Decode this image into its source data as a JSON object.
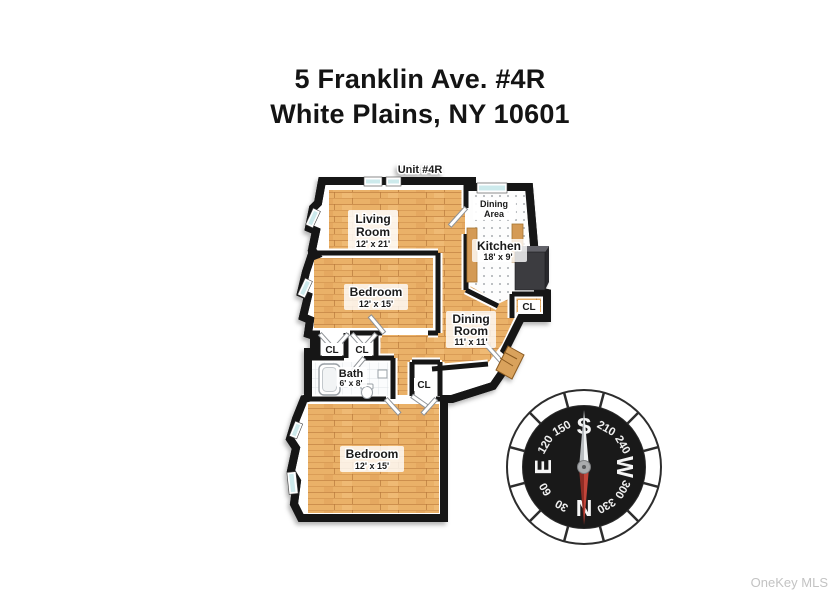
{
  "title": {
    "line1": "5 Franklin Ave. #4R",
    "line2": "White Plains, NY 10601"
  },
  "floorplan": {
    "unit_label": "Unit #4R",
    "rooms": {
      "living": {
        "name1": "Living",
        "name2": "Room",
        "dims": "12' x 21'"
      },
      "dining_area": {
        "name1": "Dining",
        "name2": "Area"
      },
      "kitchen": {
        "name": "Kitchen",
        "dims": "18' x 9'"
      },
      "bedroom1": {
        "name": "Bedroom",
        "dims": "12' x 15'"
      },
      "dining_room": {
        "name1": "Dining",
        "name2": "Room",
        "dims": "11' x 11'"
      },
      "bath": {
        "name": "Bath",
        "dims": "6' x 8'"
      },
      "bedroom2": {
        "name": "Bedroom",
        "dims": "12' x 15'"
      }
    },
    "closets": [
      "CL",
      "CL",
      "CL",
      "CL"
    ]
  },
  "compass": {
    "dial": [
      "S",
      "210",
      "240",
      "W",
      "300",
      "330",
      "N",
      "30",
      "60",
      "E",
      "120",
      "150"
    ]
  },
  "watermark": "OneKey MLS",
  "colors": {
    "wall": "#161616",
    "wood": "#eab168",
    "window_glass": "#cdeaec",
    "compass_face": "#191919",
    "needle_red": "#c2453a",
    "watermark_gray": "#c3c3c3"
  }
}
